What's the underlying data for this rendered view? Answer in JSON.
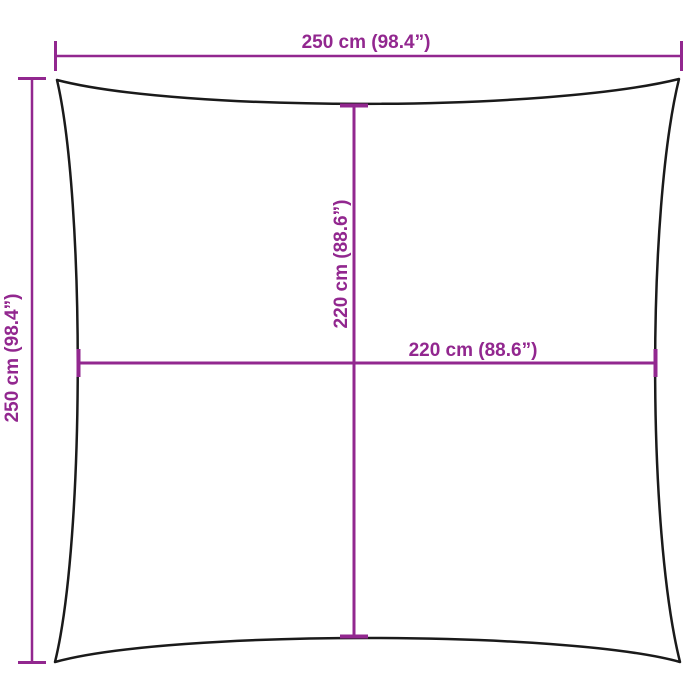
{
  "diagram": {
    "type": "product-dimension-diagram",
    "subject": "square shade sail outline with concave edges",
    "dimensions": {
      "outer_width": {
        "label": "250 cm (98.4”)",
        "cm": 250,
        "inches": 98.4
      },
      "outer_height": {
        "label": "250 cm (98.4”)",
        "cm": 250,
        "inches": 98.4
      },
      "inner_height": {
        "label": "220 cm (88.6”)",
        "cm": 220,
        "inches": 88.6
      },
      "inner_width": {
        "label": "220 cm (88.6”)",
        "cm": 220,
        "inches": 88.6
      }
    },
    "colors": {
      "dimension": "#92278F",
      "outline": "#1A1A1A",
      "background": "#FFFFFF"
    }
  }
}
